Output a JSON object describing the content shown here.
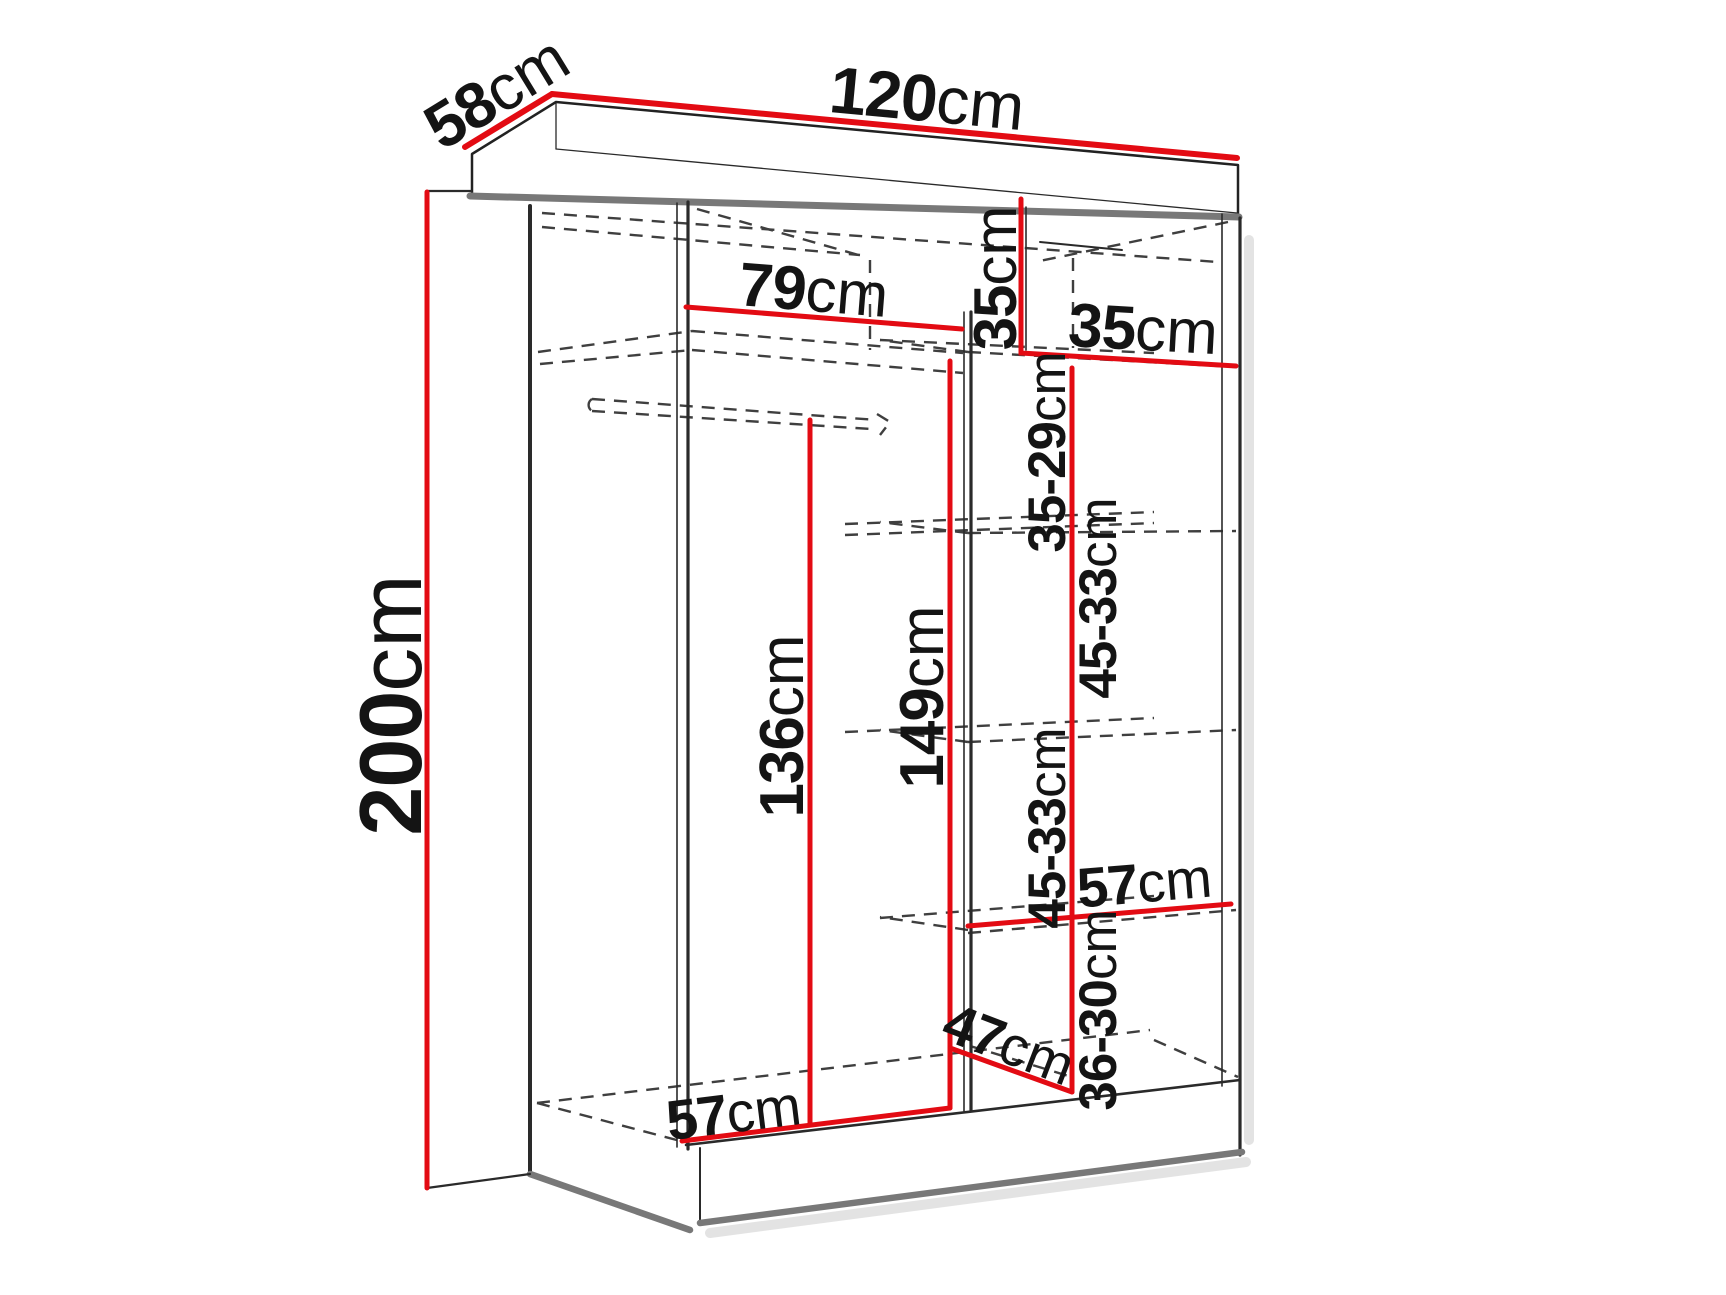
{
  "diagram": {
    "type": "furniture-dimension-diagram",
    "subject": "Sliding-door wardrobe interior dimension drawing",
    "units": "cm",
    "background": "#ffffff"
  },
  "colors": {
    "accent": "#e30b13",
    "ink": "#141414",
    "outline": "#2a2a2a",
    "gray": "#787878",
    "dash": "#3f3f3f",
    "shadow": "#cccccc",
    "bg": "#ffffff"
  },
  "labels": {
    "depth": {
      "value": "58",
      "unit": "cm"
    },
    "width": {
      "value": "120",
      "unit": "cm"
    },
    "height": {
      "value": "200",
      "unit": "cm"
    },
    "left_compartment_width": {
      "value": "79",
      "unit": "cm"
    },
    "top_compartment_height": {
      "value": "35",
      "unit": "cm"
    },
    "right_compartment_width": {
      "value": "35",
      "unit": "cm"
    },
    "right_gap_top": {
      "value": "35-29",
      "unit": "cm"
    },
    "right_gap_upper": {
      "value": "45-33",
      "unit": "cm"
    },
    "right_gap_lower": {
      "value": "45-33",
      "unit": "cm"
    },
    "hanging_section_height": {
      "value": "136",
      "unit": "cm"
    },
    "right_section_height": {
      "value": "149",
      "unit": "cm"
    },
    "right_shelf_width": {
      "value": "57",
      "unit": "cm"
    },
    "right_gap_bottom": {
      "value": "36-30",
      "unit": "cm"
    },
    "bottom_shelf_depth": {
      "value": "47",
      "unit": "cm"
    },
    "interior_floor_depth": {
      "value": "57",
      "unit": "cm"
    }
  }
}
